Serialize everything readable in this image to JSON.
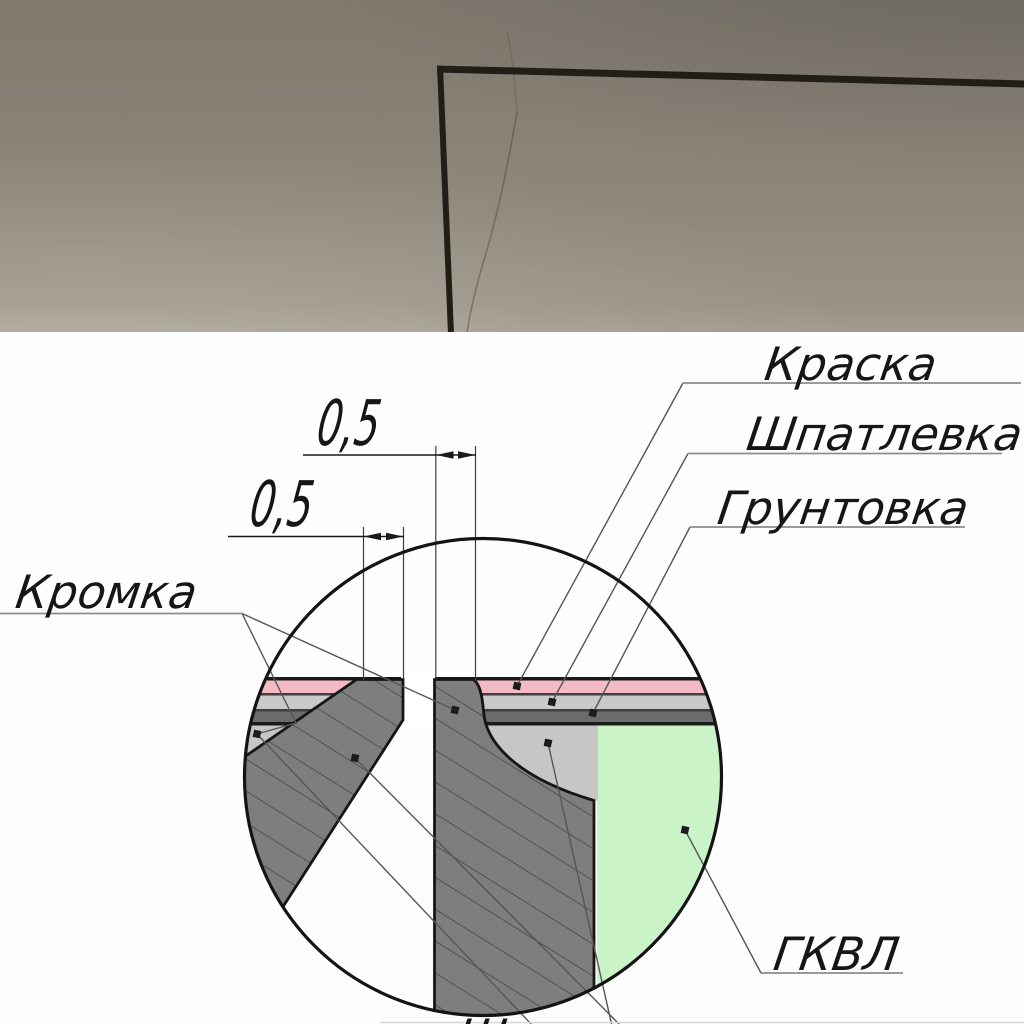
{
  "photo": {
    "wall_color": "#8b8478",
    "corner_line_color": "#211e18"
  },
  "diagram": {
    "labels": {
      "paint": "Краска",
      "putty": "Шпатлевка",
      "primer": "Грунтовка",
      "edge": "Кромка",
      "board": "ГКВЛ",
      "bottom_partial": "Шпатлевка"
    },
    "dimensions": {
      "right_board_edge_mm": "0,5",
      "left_board_edge_mm": "0,5"
    },
    "colors": {
      "paint": "#f3bac6",
      "putty": "#c6c6c6",
      "putty_band": "#c9c9c9",
      "primer": "#6c6c6c",
      "board_section": "#7e7e7e",
      "gkvl": "#cbf3c8"
    }
  }
}
